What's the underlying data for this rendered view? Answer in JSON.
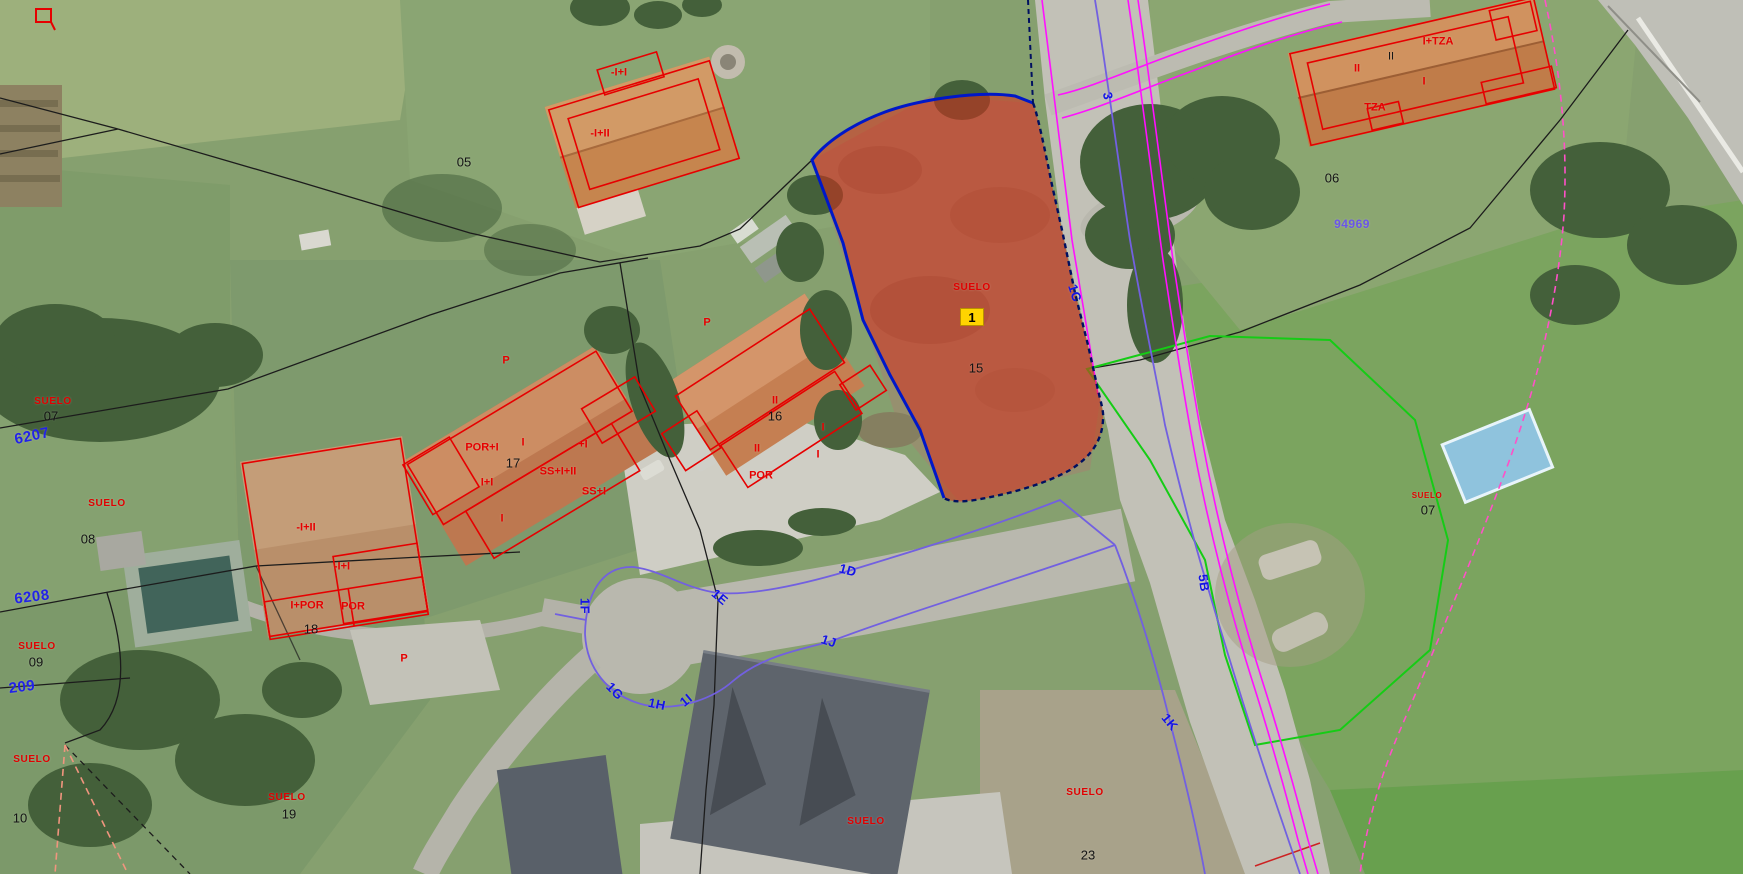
{
  "app": {
    "type": "cadastral-aerial-map-viewer"
  },
  "colors": {
    "selected_parcel_fill": "#d92b1c",
    "selected_parcel_border_solid": "#0018c8",
    "selected_parcel_border_dashed": "#001060",
    "street_axis_line": "#7260e0",
    "street_code_label": "#1414e6",
    "cadastral_building_red": "#e60000",
    "land_use_red": "#e00000",
    "boundary_black": "#1c1c1c",
    "road_boundary_magenta": "#ff10ff",
    "boundary_green": "#15cc15",
    "boundary_pink_dashed": "#ff50c8",
    "boundary_salmon_dashed": "#f0957e",
    "marker_badge_bg": "#ffd400",
    "cadastral_ref_blue": "#2222e8"
  },
  "selected_parcel": {
    "land_use": "SUELO",
    "marker": "1",
    "number": "15",
    "land_use_pos": {
      "x": 972,
      "y": 288
    },
    "marker_pos": {
      "x": 972,
      "y": 317
    },
    "number_pos": {
      "x": 976,
      "y": 368
    }
  },
  "labels": {
    "street_codes": [
      {
        "text": "3",
        "x": 1108,
        "y": 96,
        "rot": 80
      },
      {
        "text": "1C",
        "x": 1075,
        "y": 293,
        "rot": 72
      },
      {
        "text": "5B",
        "x": 1204,
        "y": 583,
        "rot": 82
      },
      {
        "text": "1K",
        "x": 1170,
        "y": 722,
        "rot": 50
      },
      {
        "text": "1D",
        "x": 848,
        "y": 570,
        "rot": 15
      },
      {
        "text": "1J",
        "x": 829,
        "y": 641,
        "rot": 18
      },
      {
        "text": "1E",
        "x": 720,
        "y": 597,
        "rot": 40
      },
      {
        "text": "1F",
        "x": 585,
        "y": 606,
        "rot": 90
      },
      {
        "text": "1G",
        "x": 615,
        "y": 691,
        "rot": 46
      },
      {
        "text": "1H",
        "x": 657,
        "y": 704,
        "rot": 12
      },
      {
        "text": "1I",
        "x": 686,
        "y": 700,
        "rot": -40
      }
    ],
    "blue_refs": [
      {
        "text": "6207",
        "x": 32,
        "y": 436,
        "rot": -12
      },
      {
        "text": "6208",
        "x": 32,
        "y": 597,
        "rot": -7
      },
      {
        "text": "209",
        "x": 22,
        "y": 687,
        "rot": -7
      },
      {
        "text": "94969",
        "x": 1352,
        "y": 224,
        "rot": 0,
        "size": 12,
        "color": "#6a55e8"
      }
    ],
    "land_use": [
      {
        "text": "SUELO",
        "x": 53,
        "y": 402
      },
      {
        "text": "SUELO",
        "x": 107,
        "y": 504
      },
      {
        "text": "SUELO",
        "x": 37,
        "y": 647
      },
      {
        "text": "SUELO",
        "x": 32,
        "y": 760
      },
      {
        "text": "SUELO",
        "x": 287,
        "y": 798
      },
      {
        "text": "SUELO",
        "x": 866,
        "y": 822
      },
      {
        "text": "SUELO",
        "x": 1085,
        "y": 793
      },
      {
        "text": "SUELO",
        "x": 1427,
        "y": 496,
        "size": 8
      }
    ],
    "parcel_numbers": [
      {
        "text": "05",
        "x": 464,
        "y": 162
      },
      {
        "text": "06",
        "x": 1332,
        "y": 178
      },
      {
        "text": "07",
        "x": 51,
        "y": 416
      },
      {
        "text": "08",
        "x": 88,
        "y": 539
      },
      {
        "text": "09",
        "x": 36,
        "y": 662
      },
      {
        "text": "10",
        "x": 20,
        "y": 818
      },
      {
        "text": "16",
        "x": 775,
        "y": 416
      },
      {
        "text": "17",
        "x": 513,
        "y": 463
      },
      {
        "text": "18",
        "x": 311,
        "y": 629
      },
      {
        "text": "19",
        "x": 289,
        "y": 814
      },
      {
        "text": "23",
        "x": 1088,
        "y": 855
      },
      {
        "text": "07",
        "x": 1428,
        "y": 510
      }
    ],
    "floor_counts": [
      {
        "text": "II",
        "x": 1391,
        "y": 57
      }
    ],
    "building_volumes": [
      {
        "text": "-I+I",
        "x": 619,
        "y": 73
      },
      {
        "text": "-I+II",
        "x": 600,
        "y": 134
      },
      {
        "text": "I+TZA",
        "x": 1438,
        "y": 42
      },
      {
        "text": "II",
        "x": 1357,
        "y": 69
      },
      {
        "text": "I",
        "x": 1424,
        "y": 82
      },
      {
        "text": "TZA",
        "x": 1375,
        "y": 108
      },
      {
        "text": "POR+I",
        "x": 482,
        "y": 448
      },
      {
        "text": "I",
        "x": 523,
        "y": 443
      },
      {
        "text": "+I",
        "x": 583,
        "y": 445
      },
      {
        "text": "SS+I+II",
        "x": 558,
        "y": 472
      },
      {
        "text": "I+I",
        "x": 487,
        "y": 483
      },
      {
        "text": "SS+I",
        "x": 594,
        "y": 492
      },
      {
        "text": "I",
        "x": 502,
        "y": 519
      },
      {
        "text": "-I+II",
        "x": 306,
        "y": 528
      },
      {
        "text": "-I+I",
        "x": 342,
        "y": 567
      },
      {
        "text": "I+POR",
        "x": 307,
        "y": 606
      },
      {
        "text": "POR",
        "x": 353,
        "y": 607
      },
      {
        "text": "P",
        "x": 404,
        "y": 659
      },
      {
        "text": "II",
        "x": 775,
        "y": 401
      },
      {
        "text": "II",
        "x": 757,
        "y": 449
      },
      {
        "text": "I",
        "x": 823,
        "y": 428
      },
      {
        "text": "POR",
        "x": 761,
        "y": 476
      },
      {
        "text": "I",
        "x": 818,
        "y": 455
      },
      {
        "text": "P",
        "x": 707,
        "y": 323
      },
      {
        "text": "P",
        "x": 506,
        "y": 361
      }
    ]
  }
}
